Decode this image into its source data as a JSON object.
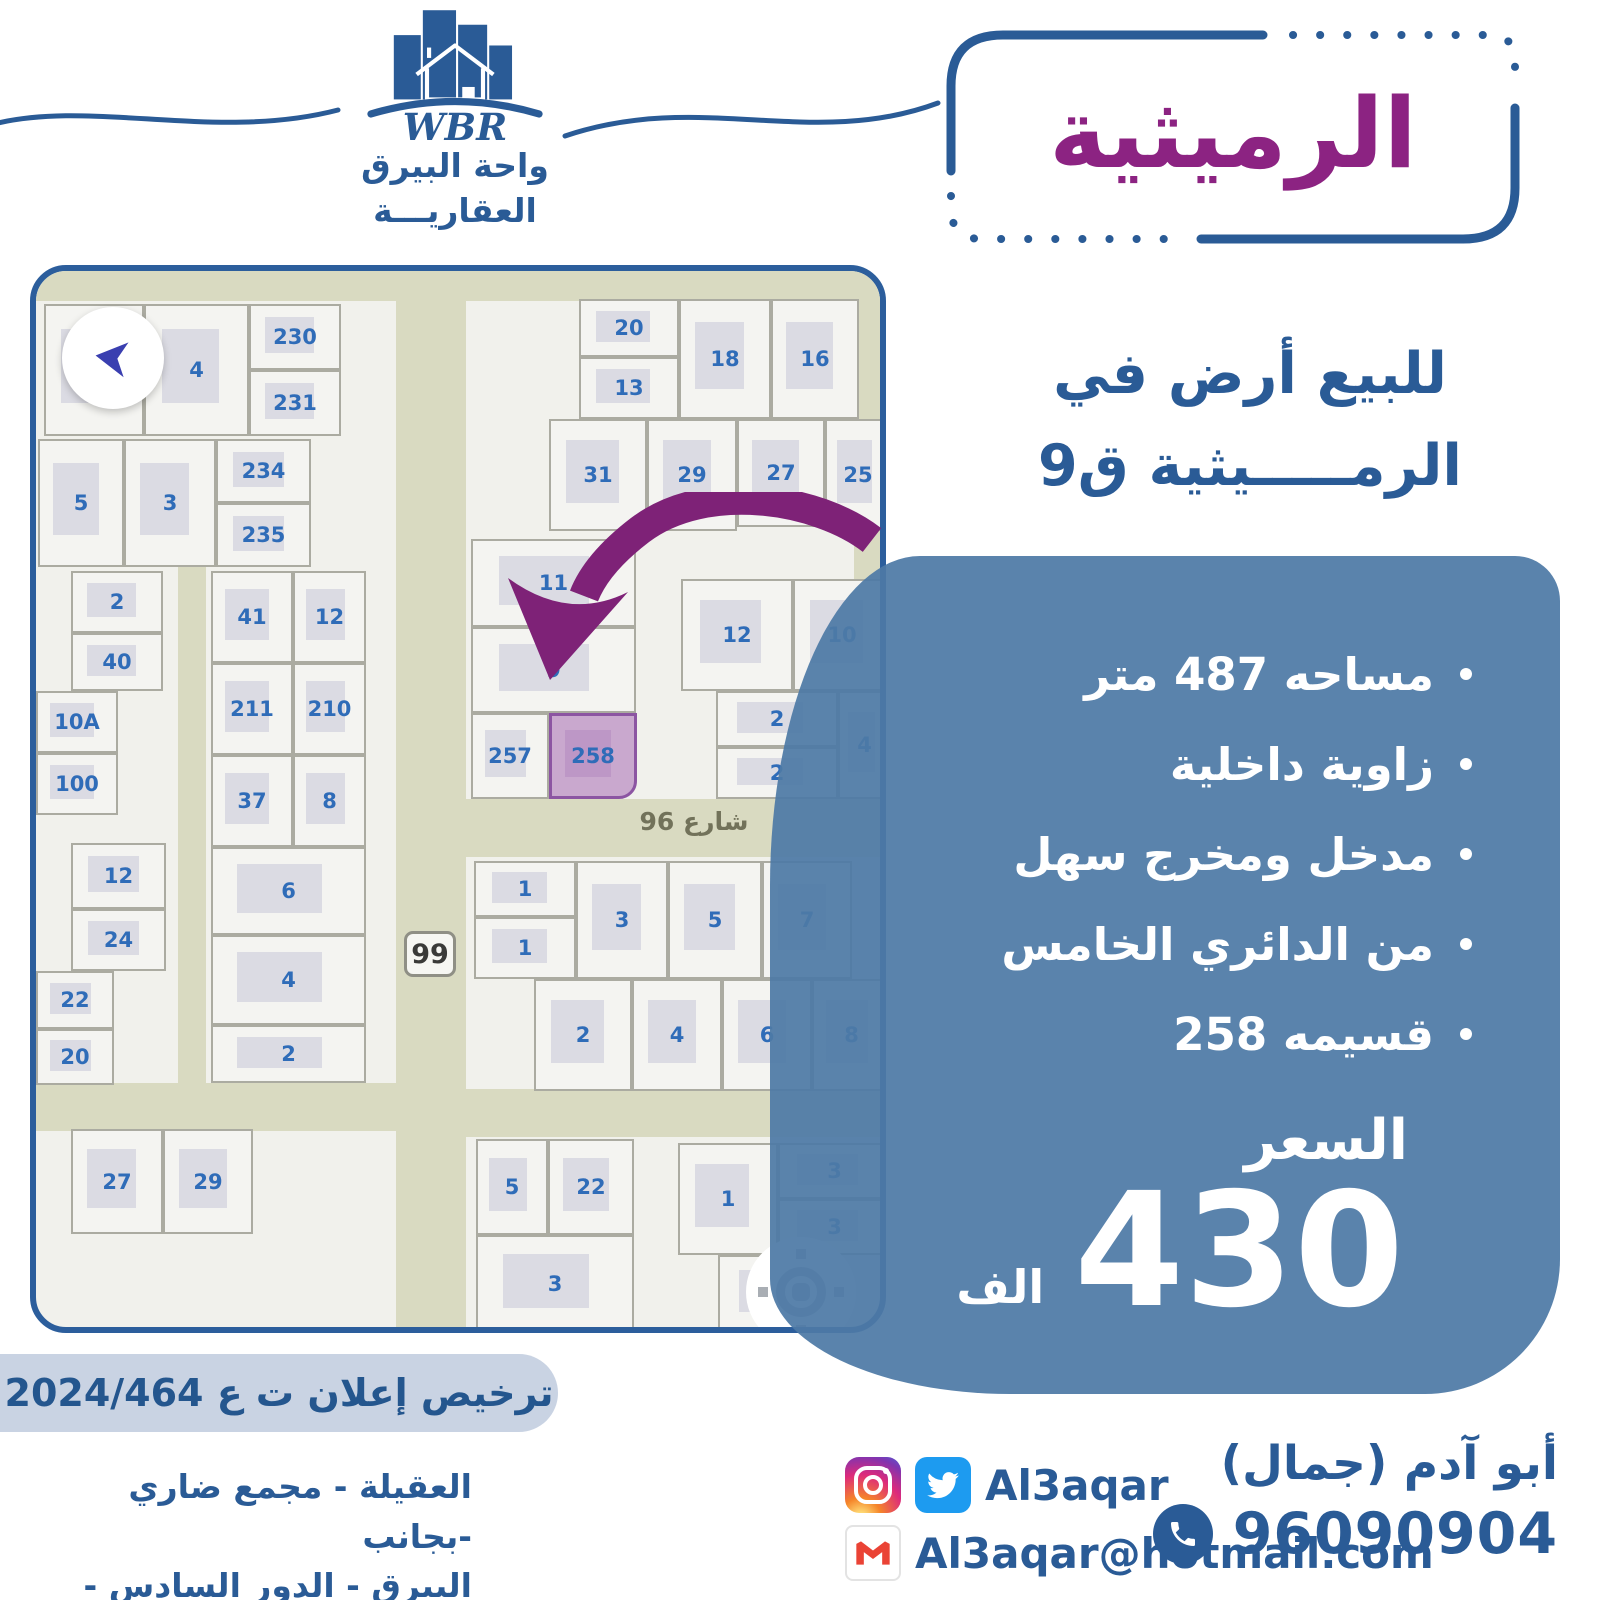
{
  "brand": {
    "wbr": "WBR",
    "name_line1": "واحة البيرق",
    "name_line2": "العقاريـــة"
  },
  "title": "الرميثية",
  "subtitle": {
    "line1": "للبيع أرض في",
    "line2": "الرمـــــيثية ق9"
  },
  "features": [
    "مساحه 487 متر",
    "زاوية داخلية",
    "مدخل ومخرج سهل",
    "من الدائري الخامس",
    "قسيمه 258"
  ],
  "price": {
    "label": "السعر",
    "amount": "430",
    "unit": "الف"
  },
  "license": "ترخيص إعلان ت ع 2024/464",
  "address": {
    "line1": "العقيلة - مجمع ضاري -بجانب",
    "line2": "البيرق - الدور السادس - مكتب 6"
  },
  "contact": {
    "name": "أبو آدم (جمال)",
    "phone": "96090904",
    "social_handle": "Al3aqar",
    "email": "Al3aqar@hotmail.com"
  },
  "colors": {
    "blue": "#2A5B96",
    "purple": "#8C2382",
    "panel_blue": "#4D7AA6",
    "highlight_pink": "#C9A8CE",
    "road_beige": "#D9DAC1",
    "twitter_blue": "#1D9BF0",
    "gmail_red": "#EA4335"
  },
  "map": {
    "street_label": "شارع 96",
    "route_badge": "99",
    "highlight_plot": "258",
    "roads": [
      {
        "x": 0,
        "y": 0,
        "w": 856,
        "h": 30
      },
      {
        "x": 360,
        "y": 0,
        "w": 70,
        "h": 1062
      },
      {
        "x": 430,
        "y": 528,
        "w": 426,
        "h": 58
      },
      {
        "x": 0,
        "y": 812,
        "w": 360,
        "h": 48
      },
      {
        "x": 430,
        "y": 818,
        "w": 426,
        "h": 48
      },
      {
        "x": 142,
        "y": 295,
        "w": 28,
        "h": 520
      },
      {
        "x": 818,
        "y": 0,
        "w": 38,
        "h": 528
      }
    ],
    "plots": [
      {
        "label": "",
        "x": 8,
        "y": 33,
        "w": 100,
        "h": 132
      },
      {
        "label": "4",
        "x": 108,
        "y": 33,
        "w": 105,
        "h": 132
      },
      {
        "label": "230",
        "x": 213,
        "y": 33,
        "w": 92,
        "h": 66
      },
      {
        "label": "231",
        "x": 213,
        "y": 99,
        "w": 92,
        "h": 66
      },
      {
        "label": "5",
        "x": 2,
        "y": 168,
        "w": 86,
        "h": 128
      },
      {
        "label": "3",
        "x": 88,
        "y": 168,
        "w": 92,
        "h": 128
      },
      {
        "label": "234",
        "x": 180,
        "y": 168,
        "w": 95,
        "h": 64
      },
      {
        "label": "235",
        "x": 180,
        "y": 232,
        "w": 95,
        "h": 64
      },
      {
        "label": "20",
        "x": 543,
        "y": 28,
        "w": 100,
        "h": 58
      },
      {
        "label": "13",
        "x": 543,
        "y": 86,
        "w": 100,
        "h": 62
      },
      {
        "label": "18",
        "x": 643,
        "y": 28,
        "w": 92,
        "h": 120
      },
      {
        "label": "16",
        "x": 735,
        "y": 28,
        "w": 88,
        "h": 120
      },
      {
        "label": "31",
        "x": 513,
        "y": 148,
        "w": 98,
        "h": 112
      },
      {
        "label": "29",
        "x": 611,
        "y": 148,
        "w": 90,
        "h": 112
      },
      {
        "label": "27",
        "x": 701,
        "y": 148,
        "w": 88,
        "h": 108
      },
      {
        "label": "25",
        "x": 789,
        "y": 148,
        "w": 66,
        "h": 112
      },
      {
        "label": "2",
        "x": 35,
        "y": 300,
        "w": 92,
        "h": 62
      },
      {
        "label": "40",
        "x": 35,
        "y": 362,
        "w": 92,
        "h": 58
      },
      {
        "label": "10A",
        "x": 0,
        "y": 420,
        "w": 82,
        "h": 62
      },
      {
        "label": "100",
        "x": 0,
        "y": 482,
        "w": 82,
        "h": 62
      },
      {
        "label": "12",
        "x": 35,
        "y": 572,
        "w": 95,
        "h": 66
      },
      {
        "label": "24",
        "x": 35,
        "y": 638,
        "w": 95,
        "h": 62
      },
      {
        "label": "22",
        "x": 0,
        "y": 700,
        "w": 78,
        "h": 58
      },
      {
        "label": "20",
        "x": 0,
        "y": 758,
        "w": 78,
        "h": 56
      },
      {
        "label": "27",
        "x": 35,
        "y": 858,
        "w": 92,
        "h": 105
      },
      {
        "label": "29",
        "x": 127,
        "y": 858,
        "w": 90,
        "h": 105
      },
      {
        "label": "41",
        "x": 175,
        "y": 300,
        "w": 82,
        "h": 92
      },
      {
        "label": "12",
        "x": 257,
        "y": 300,
        "w": 73,
        "h": 92
      },
      {
        "label": "211",
        "x": 175,
        "y": 392,
        "w": 82,
        "h": 92
      },
      {
        "label": "210",
        "x": 257,
        "y": 392,
        "w": 73,
        "h": 92
      },
      {
        "label": "37",
        "x": 175,
        "y": 484,
        "w": 82,
        "h": 92
      },
      {
        "label": "8",
        "x": 257,
        "y": 484,
        "w": 73,
        "h": 92
      },
      {
        "label": "6",
        "x": 175,
        "y": 576,
        "w": 155,
        "h": 88
      },
      {
        "label": "4",
        "x": 175,
        "y": 664,
        "w": 155,
        "h": 90
      },
      {
        "label": "2",
        "x": 175,
        "y": 754,
        "w": 155,
        "h": 58
      },
      {
        "label": "11",
        "x": 435,
        "y": 268,
        "w": 165,
        "h": 88
      },
      {
        "label": "9",
        "x": 435,
        "y": 356,
        "w": 165,
        "h": 86
      },
      {
        "label": "257",
        "x": 435,
        "y": 442,
        "w": 78,
        "h": 86
      },
      {
        "label": "258",
        "x": 513,
        "y": 442,
        "w": 88,
        "h": 86,
        "hl": true
      },
      {
        "label": "12",
        "x": 645,
        "y": 308,
        "w": 112,
        "h": 112
      },
      {
        "label": "10",
        "x": 757,
        "y": 308,
        "w": 98,
        "h": 112
      },
      {
        "label": "2",
        "x": 680,
        "y": 420,
        "w": 122,
        "h": 56
      },
      {
        "label": "2",
        "x": 680,
        "y": 476,
        "w": 122,
        "h": 52
      },
      {
        "label": "4",
        "x": 802,
        "y": 420,
        "w": 53,
        "h": 108
      },
      {
        "label": "1",
        "x": 438,
        "y": 590,
        "w": 102,
        "h": 56
      },
      {
        "label": "1",
        "x": 438,
        "y": 646,
        "w": 102,
        "h": 62
      },
      {
        "label": "3",
        "x": 540,
        "y": 590,
        "w": 92,
        "h": 118
      },
      {
        "label": "5",
        "x": 632,
        "y": 590,
        "w": 94,
        "h": 118
      },
      {
        "label": "7",
        "x": 726,
        "y": 590,
        "w": 90,
        "h": 118
      },
      {
        "label": "2",
        "x": 498,
        "y": 708,
        "w": 98,
        "h": 112
      },
      {
        "label": "4",
        "x": 596,
        "y": 708,
        "w": 90,
        "h": 112
      },
      {
        "label": "6",
        "x": 686,
        "y": 708,
        "w": 90,
        "h": 112
      },
      {
        "label": "8",
        "x": 776,
        "y": 708,
        "w": 79,
        "h": 112
      },
      {
        "label": "5",
        "x": 440,
        "y": 868,
        "w": 72,
        "h": 96
      },
      {
        "label": "22",
        "x": 512,
        "y": 868,
        "w": 86,
        "h": 96
      },
      {
        "label": "3",
        "x": 440,
        "y": 964,
        "w": 158,
        "h": 98
      },
      {
        "label": "1",
        "x": 642,
        "y": 872,
        "w": 100,
        "h": 112
      },
      {
        "label": "3",
        "x": 742,
        "y": 872,
        "w": 113,
        "h": 56
      },
      {
        "label": "3",
        "x": 742,
        "y": 928,
        "w": 113,
        "h": 56
      },
      {
        "label": "7",
        "x": 682,
        "y": 984,
        "w": 120,
        "h": 76
      }
    ]
  }
}
